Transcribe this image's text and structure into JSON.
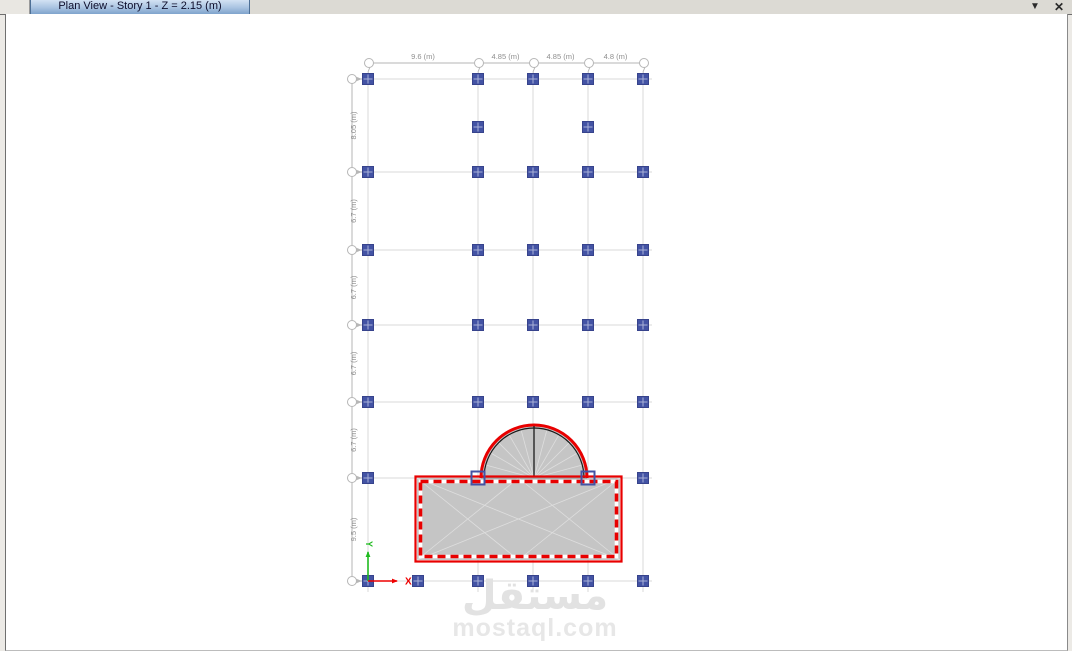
{
  "window": {
    "tab_title": "Plan View - Story 1 - Z = 2.15 (m)",
    "controls": {
      "dropdown": "▼",
      "close": "✕"
    }
  },
  "plan": {
    "colors": {
      "grid": "#d9d9d9",
      "bubble_stroke": "#b6b6b6",
      "dim_text": "#8f8f8f",
      "column_fill": "#4353a4",
      "column_stroke": "#37438c",
      "column_cross": "#a9b1d8",
      "slab_fill": "#c5c5c5",
      "mesh_line": "#dedede",
      "selection_red": "#e80000",
      "dome_black": "#1a1a1a",
      "dome_base": "#999999",
      "axis_green": "#1fbb1f",
      "axis_red": "#ee0000"
    },
    "grid": {
      "x_lines": [
        368,
        478,
        533,
        588,
        643
      ],
      "y_lines": [
        79,
        172,
        250,
        325,
        402,
        478,
        581
      ],
      "x_spans": [
        "9.6 (m)",
        "4.85 (m)",
        "4.85 (m)",
        "4.8 (m)"
      ],
      "y_spans": [
        "8.05 (m)",
        "6.7 (m)",
        "6.7 (m)",
        "6.7 (m)",
        "6.7 (m)",
        "9.5 (m)"
      ],
      "v_extent": [
        72,
        592
      ],
      "h_extent": [
        362,
        652
      ],
      "top_dim_y": 63,
      "left_dim_x": 352
    },
    "columns": {
      "size": 11,
      "filled": [
        [
          368,
          79
        ],
        [
          478,
          79
        ],
        [
          533,
          79
        ],
        [
          588,
          79
        ],
        [
          643,
          79
        ],
        [
          478,
          127
        ],
        [
          588,
          127
        ],
        [
          368,
          172
        ],
        [
          478,
          172
        ],
        [
          533,
          172
        ],
        [
          588,
          172
        ],
        [
          643,
          172
        ],
        [
          368,
          250
        ],
        [
          478,
          250
        ],
        [
          533,
          250
        ],
        [
          588,
          250
        ],
        [
          643,
          250
        ],
        [
          368,
          325
        ],
        [
          478,
          325
        ],
        [
          533,
          325
        ],
        [
          588,
          325
        ],
        [
          643,
          325
        ],
        [
          368,
          402
        ],
        [
          478,
          402
        ],
        [
          533,
          402
        ],
        [
          588,
          402
        ],
        [
          643,
          402
        ],
        [
          368,
          478
        ],
        [
          643,
          478
        ],
        [
          368,
          581
        ],
        [
          418,
          581
        ],
        [
          478,
          581
        ],
        [
          533,
          581
        ],
        [
          588,
          581
        ],
        [
          643,
          581
        ]
      ],
      "outlined": [
        [
          478,
          478
        ],
        [
          588,
          478
        ]
      ]
    },
    "slab": {
      "x1": 417,
      "y1": 478,
      "x2": 620,
      "y2": 560
    },
    "dome": {
      "cx": 534,
      "cy": 478,
      "r": 53,
      "inner_r": 50,
      "spoke_step_deg": 15
    },
    "axes": {
      "origin": [
        368,
        581
      ],
      "x_label": "X",
      "y_label": "Y",
      "x_tip": [
        397,
        581
      ],
      "y_tip": [
        368,
        552
      ]
    },
    "watermark": {
      "line1": "مستقل",
      "line2": "mostaql.com"
    }
  }
}
